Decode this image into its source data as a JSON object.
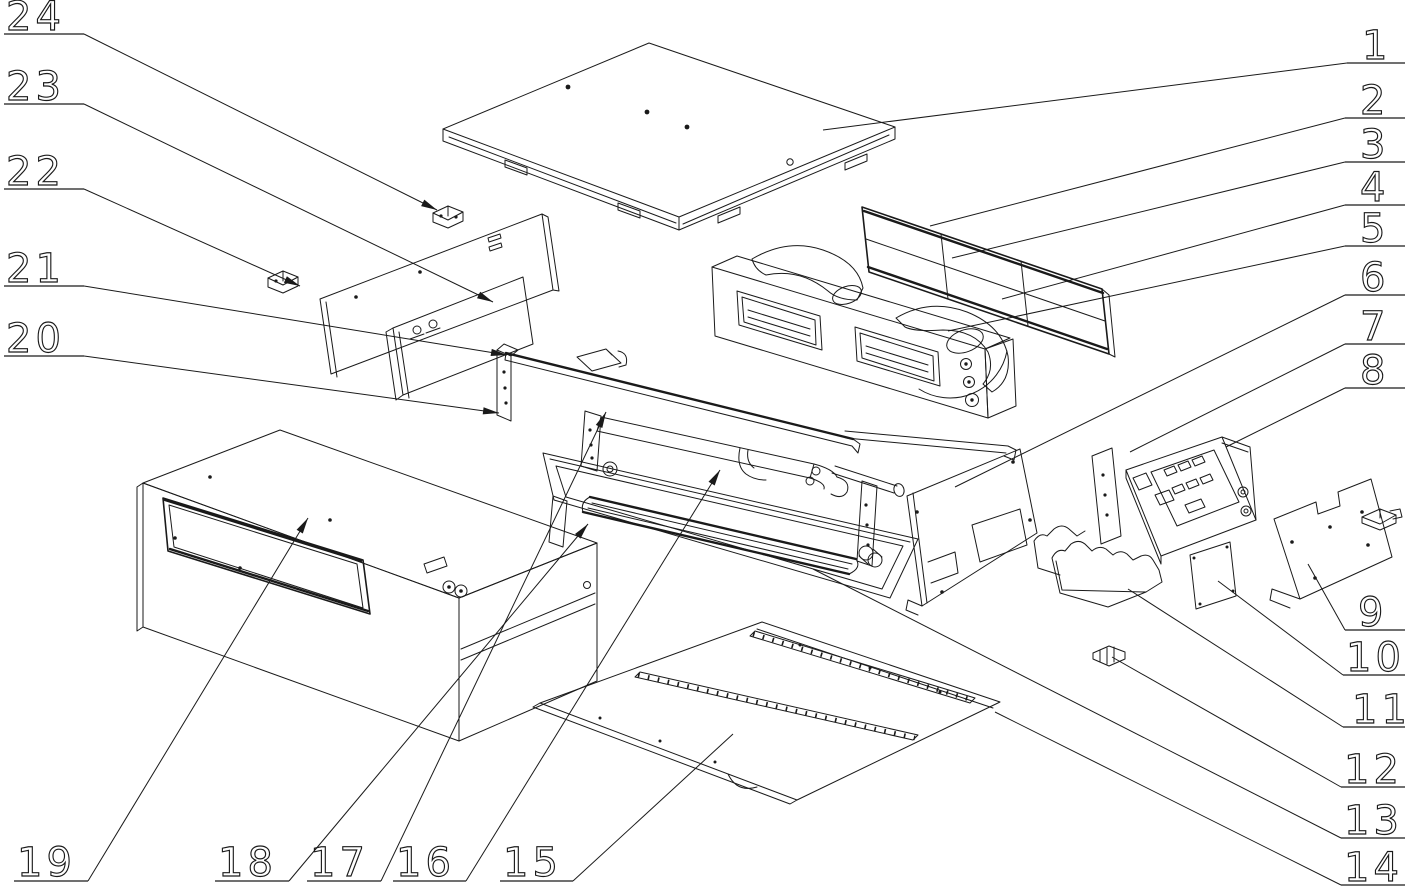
{
  "figure": {
    "kind": "exploded_assembly_line_drawing",
    "background_color": "#ffffff",
    "line_color": "#1a1a1a",
    "part_count": 24,
    "callout_numbers": [
      "1",
      "2",
      "3",
      "4",
      "5",
      "6",
      "7",
      "8",
      "9",
      "10",
      "11",
      "12",
      "13",
      "14",
      "15",
      "16",
      "17",
      "18",
      "19",
      "20",
      "21",
      "22",
      "23",
      "24"
    ]
  },
  "labels": [
    {
      "text": "1",
      "tx": 1362,
      "ty": 59,
      "ul": [
        1347,
        63,
        1405,
        63
      ],
      "leader": [
        [
          1347,
          63
        ],
        [
          823,
          130
        ]
      ],
      "arrow": false
    },
    {
      "text": "2",
      "tx": 1360,
      "ty": 114,
      "ul": [
        1345,
        118,
        1405,
        118
      ],
      "leader": [
        [
          1345,
          118
        ],
        [
          930,
          226
        ]
      ],
      "arrow": false
    },
    {
      "text": "3",
      "tx": 1360,
      "ty": 158,
      "ul": [
        1345,
        162,
        1405,
        162
      ],
      "leader": [
        [
          1345,
          162
        ],
        [
          952,
          258
        ]
      ],
      "arrow": false
    },
    {
      "text": "4",
      "tx": 1360,
      "ty": 201,
      "ul": [
        1345,
        205,
        1405,
        205
      ],
      "leader": [
        [
          1345,
          205
        ],
        [
          1002,
          299
        ]
      ],
      "arrow": false
    },
    {
      "text": "5",
      "tx": 1360,
      "ty": 242,
      "ul": [
        1345,
        246,
        1405,
        246
      ],
      "leader": [
        [
          1345,
          246
        ],
        [
          948,
          331
        ]
      ],
      "arrow": false
    },
    {
      "text": "6",
      "tx": 1360,
      "ty": 291,
      "ul": [
        1345,
        295,
        1405,
        295
      ],
      "leader": [
        [
          1345,
          295
        ],
        [
          955,
          487
        ]
      ],
      "arrow": false
    },
    {
      "text": "7",
      "tx": 1360,
      "ty": 340,
      "ul": [
        1345,
        344,
        1405,
        344
      ],
      "leader": [
        [
          1345,
          344
        ],
        [
          1130,
          452
        ]
      ],
      "arrow": false
    },
    {
      "text": "8",
      "tx": 1360,
      "ty": 384,
      "ul": [
        1345,
        388,
        1405,
        388
      ],
      "leader": [
        [
          1345,
          388
        ],
        [
          1226,
          447
        ]
      ],
      "arrow": false
    },
    {
      "text": "9",
      "tx": 1358,
      "ty": 626,
      "ul": [
        1345,
        630,
        1405,
        630
      ],
      "leader": [
        [
          1345,
          630
        ],
        [
          1308,
          564
        ]
      ],
      "arrow": false
    },
    {
      "text": "10",
      "tx": 1346,
      "ty": 671,
      "ul": [
        1343,
        675,
        1405,
        675
      ],
      "leader": [
        [
          1343,
          675
        ],
        [
          1218,
          581
        ]
      ],
      "arrow": false
    },
    {
      "text": "11",
      "tx": 1352,
      "ty": 723,
      "ul": [
        1343,
        727,
        1405,
        727
      ],
      "leader": [
        [
          1343,
          727
        ],
        [
          1128,
          589
        ]
      ],
      "arrow": false
    },
    {
      "text": "12",
      "tx": 1344,
      "ty": 783,
      "ul": [
        1341,
        787,
        1405,
        787
      ],
      "leader": [
        [
          1341,
          787
        ],
        [
          1112,
          657
        ]
      ],
      "arrow": false
    },
    {
      "text": "13",
      "tx": 1344,
      "ty": 834,
      "ul": [
        1341,
        838,
        1405,
        838
      ],
      "leader": [
        [
          1341,
          838
        ],
        [
          813,
          569
        ]
      ],
      "arrow": false
    },
    {
      "text": "14",
      "tx": 1344,
      "ty": 881,
      "ul": [
        1341,
        885,
        1405,
        885
      ],
      "leader": [
        [
          1341,
          885
        ],
        [
          995,
          712
        ]
      ],
      "arrow": false
    },
    {
      "text": "15",
      "tx": 503,
      "ty": 876,
      "ul": [
        500,
        881,
        573,
        881
      ],
      "leader": [
        [
          573,
          881
        ],
        [
          733,
          734
        ]
      ],
      "arrow": false
    },
    {
      "text": "16",
      "tx": 396,
      "ty": 876,
      "ul": [
        393,
        881,
        466,
        881
      ],
      "leader": [
        [
          466,
          881
        ],
        [
          720,
          470
        ]
      ],
      "arrow": true
    },
    {
      "text": "17",
      "tx": 310,
      "ty": 876,
      "ul": [
        307,
        881,
        381,
        881
      ],
      "leader": [
        [
          381,
          881
        ],
        [
          606,
          412
        ]
      ],
      "arrow": true
    },
    {
      "text": "18",
      "tx": 218,
      "ty": 876,
      "ul": [
        215,
        881,
        289,
        881
      ],
      "leader": [
        [
          289,
          881
        ],
        [
          588,
          524
        ]
      ],
      "arrow": true
    },
    {
      "text": "19",
      "tx": 17,
      "ty": 876,
      "ul": [
        14,
        881,
        88,
        881
      ],
      "leader": [
        [
          88,
          881
        ],
        [
          308,
          518
        ]
      ],
      "arrow": true
    },
    {
      "text": "20",
      "tx": 6,
      "ty": 352,
      "ul": [
        4,
        356,
        84,
        356
      ],
      "leader": [
        [
          84,
          356
        ],
        [
          499,
          413
        ]
      ],
      "arrow": true
    },
    {
      "text": "21",
      "tx": 6,
      "ty": 282,
      "ul": [
        4,
        286,
        84,
        286
      ],
      "leader": [
        [
          84,
          286
        ],
        [
          507,
          355
        ]
      ],
      "arrow": true
    },
    {
      "text": "22",
      "tx": 6,
      "ty": 185,
      "ul": [
        4,
        189,
        84,
        189
      ],
      "leader": [
        [
          84,
          189
        ],
        [
          300,
          286
        ]
      ],
      "arrow": true
    },
    {
      "text": "23",
      "tx": 6,
      "ty": 100,
      "ul": [
        4,
        104,
        84,
        104
      ],
      "leader": [
        [
          84,
          104
        ],
        [
          493,
          302
        ]
      ],
      "arrow": true
    },
    {
      "text": "24",
      "tx": 6,
      "ty": 30,
      "ul": [
        4,
        34,
        84,
        34
      ],
      "leader": [
        [
          84,
          34
        ],
        [
          437,
          210
        ]
      ],
      "arrow": true
    }
  ]
}
